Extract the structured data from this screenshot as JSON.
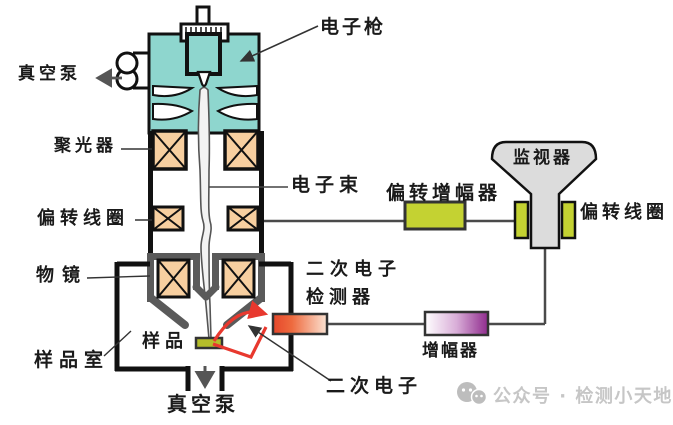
{
  "labels": {
    "electron_gun": "电子枪",
    "vacuum_pump_top": "真空泵",
    "condenser": "聚光器",
    "electron_beam": "电子束",
    "deflection_coil_left": "偏转线圈",
    "objective_lens": "物镜",
    "sample": "样品",
    "sample_chamber": "样品室",
    "vacuum_pump_bottom": "真空泵",
    "deflection_amplifier": "偏转增幅器",
    "monitor": "监视器",
    "deflection_coil_right": "偏转线圈",
    "secondary_electron_detector": {
      "line1": "二次电子",
      "line2": "检测器"
    },
    "amplifier": "增幅器",
    "secondary_electrons": "二次电子"
  },
  "watermark": {
    "icon": "wechat-icon",
    "text": "公众号 · 检测小天地"
  },
  "colors": {
    "column_teal": "#8ed6ce",
    "coil_orange": "#f7cfa0",
    "coil_green": "#c4d232",
    "sample_olive": "#b5bd2a",
    "monitor_gray": "#dcdcdc",
    "objective_gray": "#5a5a5a",
    "detector_red": "#e6472b",
    "detector_fade": "#fbe3d3",
    "amplifier_purple": "#8f2b8d",
    "secondary_red": "#e8382e",
    "outline_black": "#111111",
    "line_gray": "#4a4a4a",
    "label_color": "#1a1a1a",
    "watermark_gray": "#c6c6c6"
  }
}
